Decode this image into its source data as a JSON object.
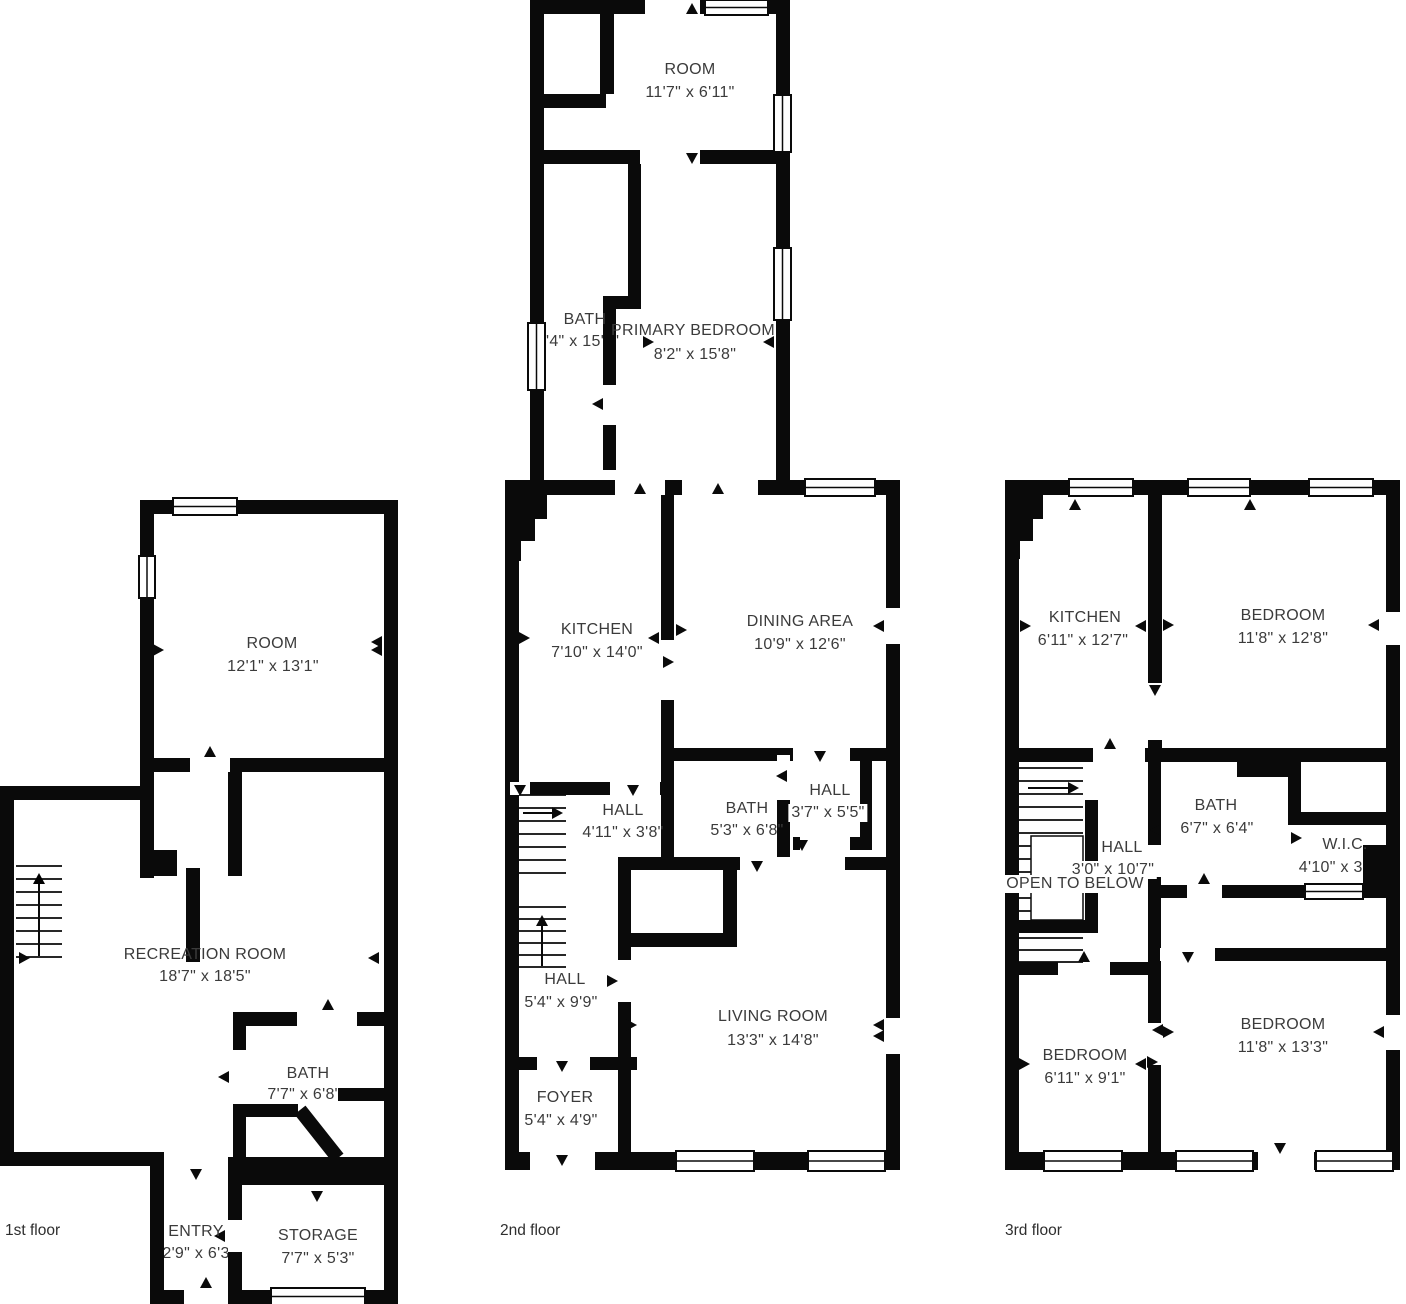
{
  "canvas": {
    "width": 1406,
    "height": 1304,
    "background": "#ffffff"
  },
  "colors": {
    "wall": "#0a0a0a",
    "room_text": "#3b3b3b",
    "floor_label_text": "#2e2e2e"
  },
  "floors": [
    {
      "label": "1st floor",
      "rooms": [
        {
          "name": "ROOM",
          "dims": "12'1\" x 13'1\""
        },
        {
          "name": "RECREATION ROOM",
          "dims": "18'7\" x 18'5\""
        },
        {
          "name": "BATH",
          "dims": "7'7\" x 6'8\""
        },
        {
          "name": "ENTRY",
          "dims": "2'9\" x 6'3\""
        },
        {
          "name": "STORAGE",
          "dims": "7'7\" x 5'3\""
        }
      ]
    },
    {
      "label": "2nd floor",
      "rooms": [
        {
          "name": "ROOM",
          "dims": "11'7\" x 6'11\""
        },
        {
          "name": "BATH",
          "dims": "4'4\" x 15'8\""
        },
        {
          "name": "PRIMARY BEDROOM",
          "dims": "8'2\" x 15'8\""
        },
        {
          "name": "KITCHEN",
          "dims": "7'10\" x 14'0\""
        },
        {
          "name": "DINING AREA",
          "dims": "10'9\" x 12'6\""
        },
        {
          "name": "HALL",
          "dims": "4'11\" x 3'8\""
        },
        {
          "name": "BATH",
          "dims": "5'3\" x 6'8\""
        },
        {
          "name": "HALL",
          "dims": "3'7\" x 5'5\""
        },
        {
          "name": "HALL",
          "dims": "5'4\" x 9'9\""
        },
        {
          "name": "FOYER",
          "dims": "5'4\" x 4'9\""
        },
        {
          "name": "LIVING ROOM",
          "dims": "13'3\" x 14'8\""
        }
      ]
    },
    {
      "label": "3rd floor",
      "rooms": [
        {
          "name": "KITCHEN",
          "dims": "6'11\" x 12'7\""
        },
        {
          "name": "BEDROOM",
          "dims": "11'8\" x 12'8\""
        },
        {
          "name": "BATH",
          "dims": "6'7\" x 6'4\""
        },
        {
          "name": "HALL",
          "dims": "3'0\" x 10'7\""
        },
        {
          "name": "OPEN TO BELOW",
          "dims": ""
        },
        {
          "name": "W.I.C.",
          "dims": "4'10\" x 3'1\""
        },
        {
          "name": "BEDROOM",
          "dims": "6'11\" x 9'1\""
        },
        {
          "name": "BEDROOM",
          "dims": "11'8\" x 13'3\""
        }
      ]
    }
  ]
}
